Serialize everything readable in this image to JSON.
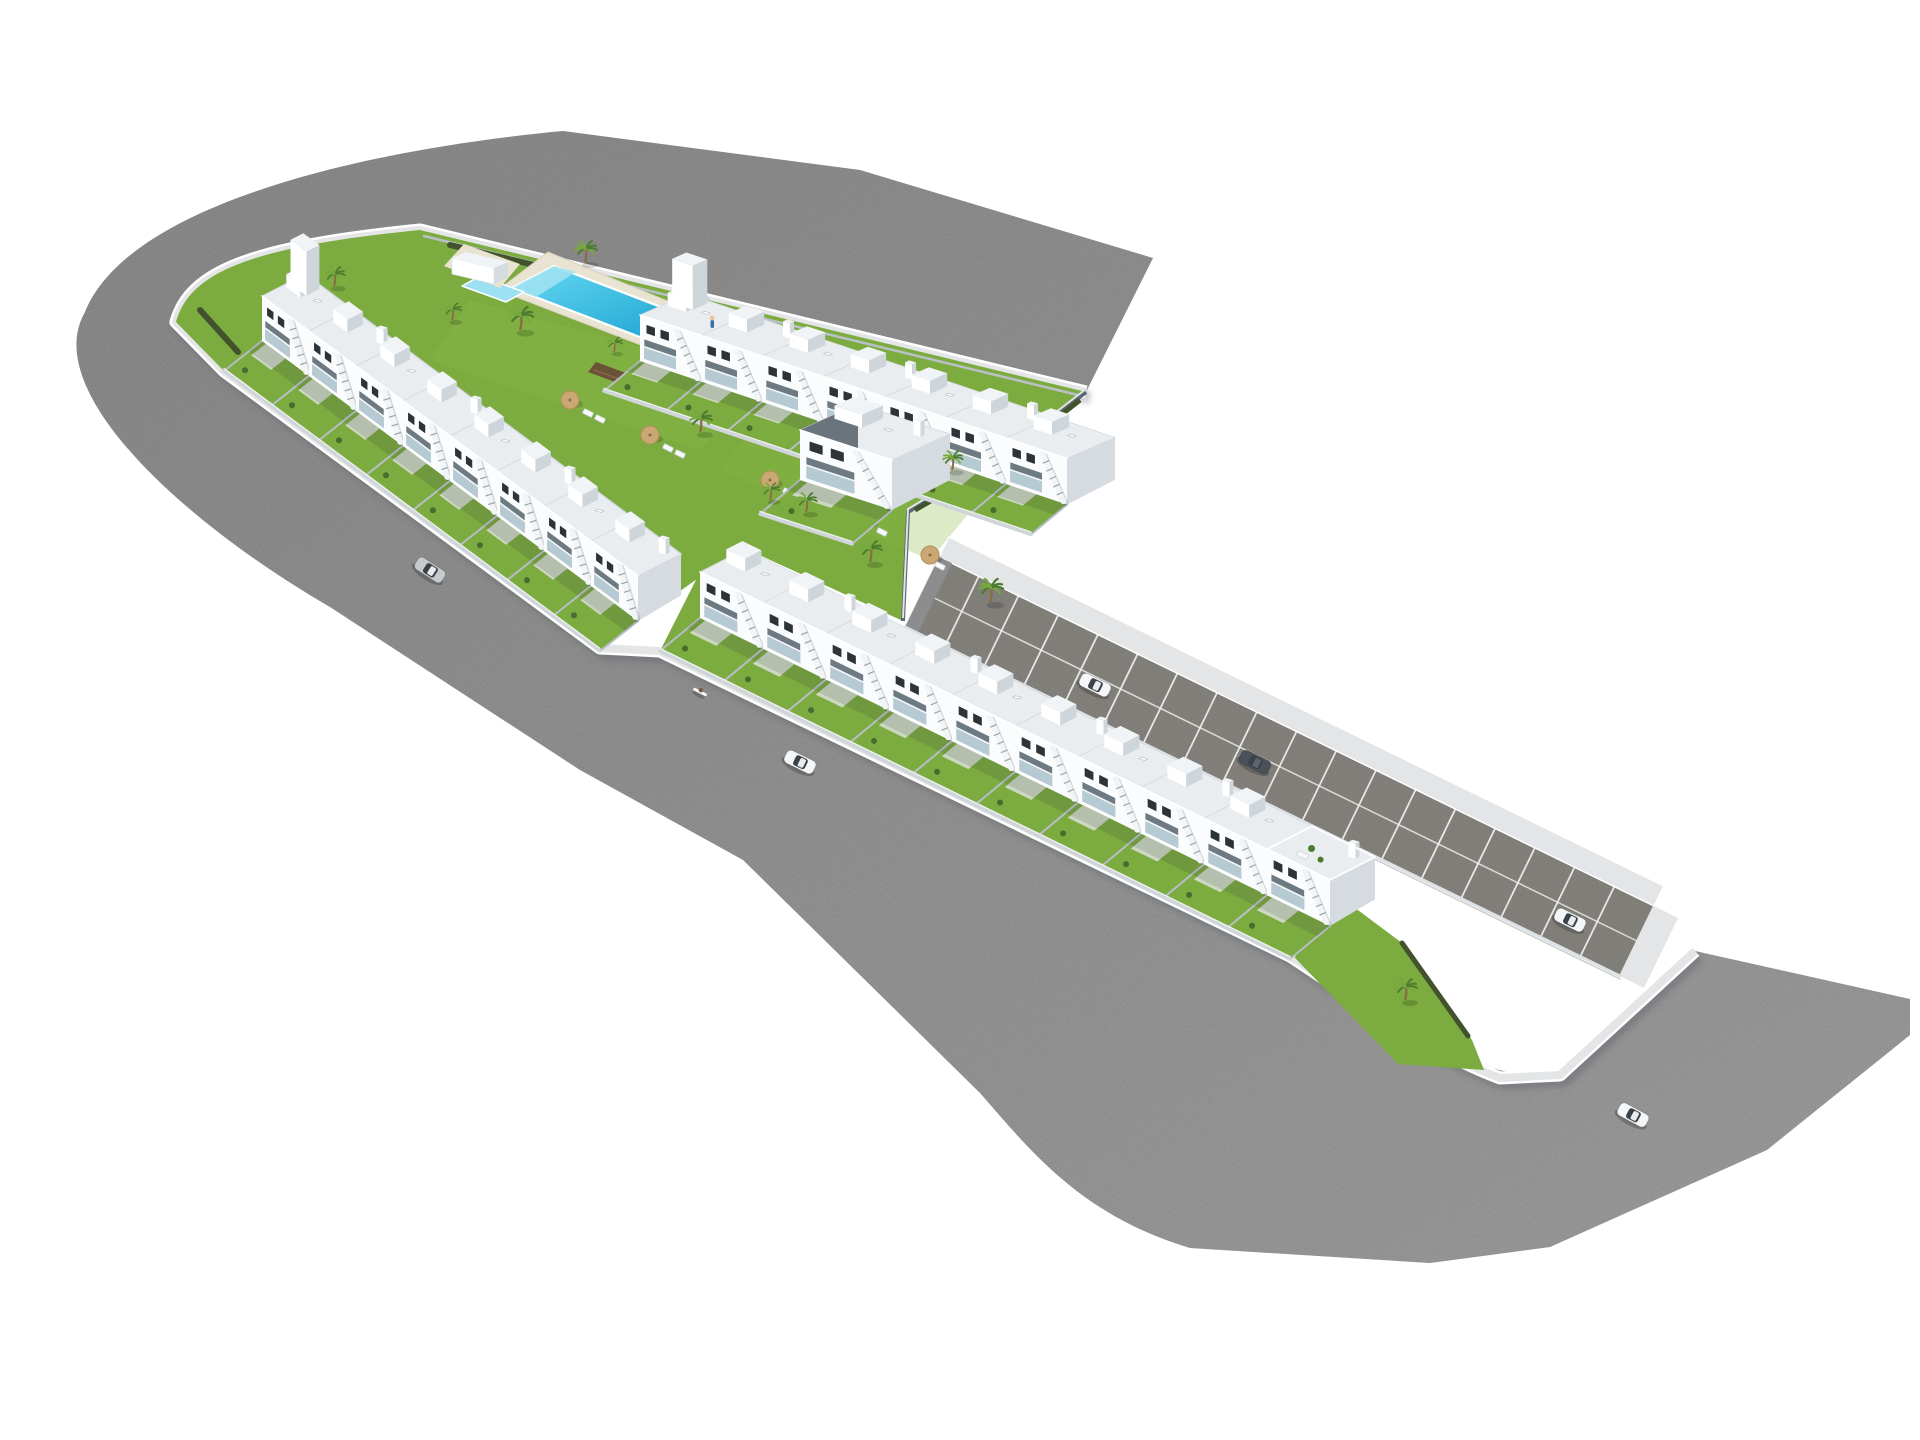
{
  "scene": {
    "description": "Aerial 3D architectural rendering of a white townhouse residential development with central pool courtyard, perimeter roads, parking strip and cars",
    "background": "#ffffff",
    "road": {
      "color_far": "#969696",
      "color_near": "#a9a9a9",
      "sidewalk": "#e3e5e6",
      "curb": "#ffffff"
    },
    "parking": {
      "surface": "#93908a",
      "line_color": "#f2f2ef",
      "bays": 18
    },
    "site": {
      "grass": "#7cab3f",
      "grass_light": "#8ab947",
      "hedge": "#41522c",
      "wall_dark": "#5d6770",
      "wall_light": "#cfd5d9",
      "fence": "#b6bec4"
    },
    "pool": {
      "water_light": "#66d9f2",
      "water_dark": "#189fd0",
      "rim": "#ffffff",
      "deck": "#e9e3d2",
      "steps": "#6b5137",
      "kiddie_water": "#9ce0f2",
      "shallow": "#9fe2f2"
    },
    "houses": {
      "roof": "#e9edef",
      "face": "#fbfcfd",
      "side": "#d5dbe0",
      "window": "#2d3439",
      "terrace_glass": "#c2d8e0",
      "terrace_shade": "#6e7a82",
      "stair": "#f2f5f6",
      "rows": [
        {
          "name": "north-row",
          "units": 7
        },
        {
          "name": "west-row",
          "units": 8
        },
        {
          "name": "south-row",
          "units": 10
        }
      ],
      "detached_units": 1
    },
    "vegetation": {
      "palm_trunk": "#8a6b46",
      "palm_frond": "#4e7c2f",
      "palm_frond_light": "#76a93e",
      "umbrella_color": "#c9a873",
      "palms": [
        [
          520,
          330,
          1.1
        ],
        [
          585,
          262,
          1.0
        ],
        [
          700,
          432,
          1.0
        ],
        [
          806,
          512,
          0.9
        ],
        [
          870,
          562,
          1.0
        ],
        [
          990,
          602,
          1.1
        ],
        [
          334,
          286,
          0.9
        ],
        [
          952,
          470,
          0.9
        ],
        [
          770,
          500,
          0.8
        ],
        [
          1405,
          1000,
          1.0
        ],
        [
          452,
          320,
          0.8
        ],
        [
          614,
          352,
          0.7
        ]
      ],
      "umbrellas": [
        [
          570,
          400
        ],
        [
          650,
          435
        ],
        [
          770,
          480
        ],
        [
          865,
          520
        ],
        [
          930,
          555
        ]
      ],
      "loungers": [
        [
          588,
          413
        ],
        [
          600,
          419
        ],
        [
          668,
          448
        ],
        [
          680,
          454
        ],
        [
          788,
          492
        ],
        [
          800,
          498
        ],
        [
          882,
          532
        ],
        [
          940,
          566
        ]
      ]
    },
    "vehicles": {
      "cars": [
        {
          "type": "silver-car",
          "color": "#c6cacd",
          "x": 430,
          "y": 570,
          "angle": 33
        },
        {
          "type": "white-car",
          "color": "#f4f6f7",
          "x": 800,
          "y": 762,
          "angle": 26
        },
        {
          "type": "white-car",
          "color": "#f4f6f7",
          "x": 1095,
          "y": 685,
          "angle": 26
        },
        {
          "type": "dark-sedan",
          "color": "#4a5158",
          "x": 1255,
          "y": 762,
          "angle": 26
        },
        {
          "type": "white-car",
          "color": "#f4f6f7",
          "x": 1570,
          "y": 920,
          "angle": 26
        },
        {
          "type": "white-car",
          "color": "#f4f6f7",
          "x": 1633,
          "y": 1115,
          "angle": 28
        }
      ],
      "scooter": {
        "x": 700,
        "y": 692,
        "angle": 27
      }
    },
    "people": [
      {
        "x": 712,
        "y": 320,
        "role": "person-at-pool"
      }
    ]
  }
}
